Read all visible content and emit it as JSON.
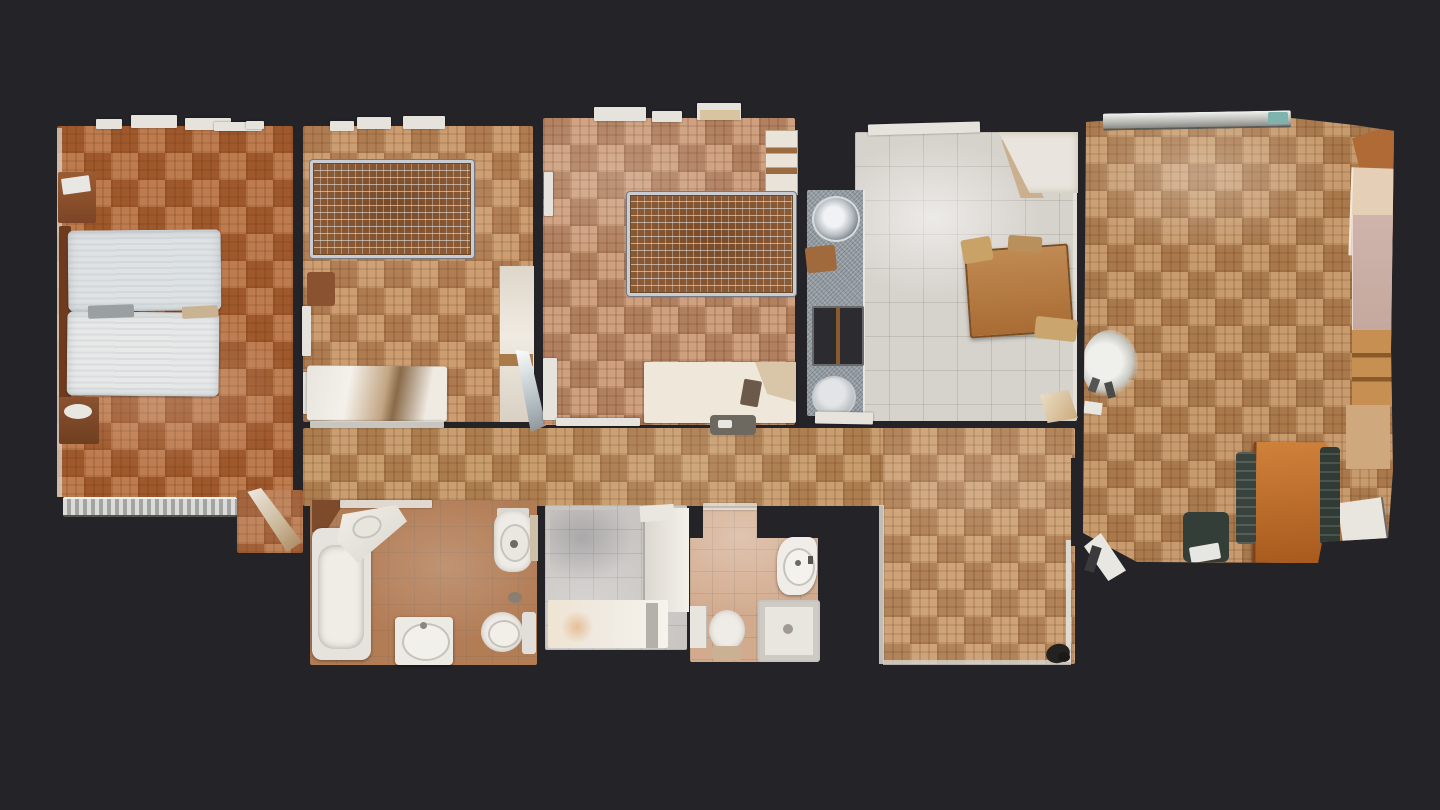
{
  "app": {
    "title": "Apartment floor plan — top-down 3D scan view"
  },
  "palette": {
    "background": "#232328",
    "wall_dark": "#1d1d21",
    "parquet_master": "#ad6233",
    "parquet_bedroom2": "#bf8c5e",
    "parquet_bedroom3": "#c29070",
    "parquet_hallway": "#bc8d5c",
    "parquet_foyer": "#c29468",
    "parquet_living": "#b9895a",
    "kitchen_tile": "#d6d2cc",
    "counter_granite": "#969ea5",
    "bath1_tile": "#b27c55",
    "laundry_tile": "#c8c5c2",
    "bath2_tile": "#d2ab8e",
    "fixture_white": "#efece7",
    "mattress_white": "#e2e6e7",
    "dining_table_wood": "#c0712c",
    "kitchen_table_wood": "#b8874f",
    "chair_dark_green": "#39433d",
    "bed_mesh_frame": "#c9cdd3",
    "radiator_gray": "#c9c9c6"
  },
  "scene": {
    "type": "apartment-floorplan-top-view",
    "rooms": [
      {
        "name": "master-bedroom",
        "furniture": [
          "double-bed-mattresses",
          "headboard",
          "cabinet",
          "nightstand",
          "radiator",
          "open-door"
        ]
      },
      {
        "name": "bedroom-2",
        "furniture": [
          "mesh-bed-frame",
          "dresser",
          "wardrobe",
          "stool",
          "mirror-door"
        ]
      },
      {
        "name": "bedroom-3",
        "furniture": [
          "mesh-bed-frame",
          "desk",
          "tall-shelf",
          "chair"
        ]
      },
      {
        "name": "kitchen",
        "furniture": [
          "granite-counter",
          "round-sink",
          "cooktop",
          "lower-basin",
          "wood-table",
          "corner-cabinet",
          "open-door"
        ]
      },
      {
        "name": "living-room",
        "furniture": [
          "dining-table",
          "chairs",
          "wardrobe",
          "shelving",
          "floor-lamp",
          "radiator",
          "entry-door"
        ]
      },
      {
        "name": "hallway",
        "furniture": []
      },
      {
        "name": "foyer",
        "furniture": [
          "dark-object"
        ]
      },
      {
        "name": "bathroom-1",
        "furniture": [
          "bathtub",
          "vanity",
          "bidet",
          "toilet",
          "pedestal-sink"
        ]
      },
      {
        "name": "laundry-room",
        "furniture": [
          "counter",
          "worktop"
        ]
      },
      {
        "name": "bathroom-2",
        "furniture": [
          "sink",
          "toilet",
          "shower-tray",
          "cabinet"
        ]
      }
    ]
  }
}
